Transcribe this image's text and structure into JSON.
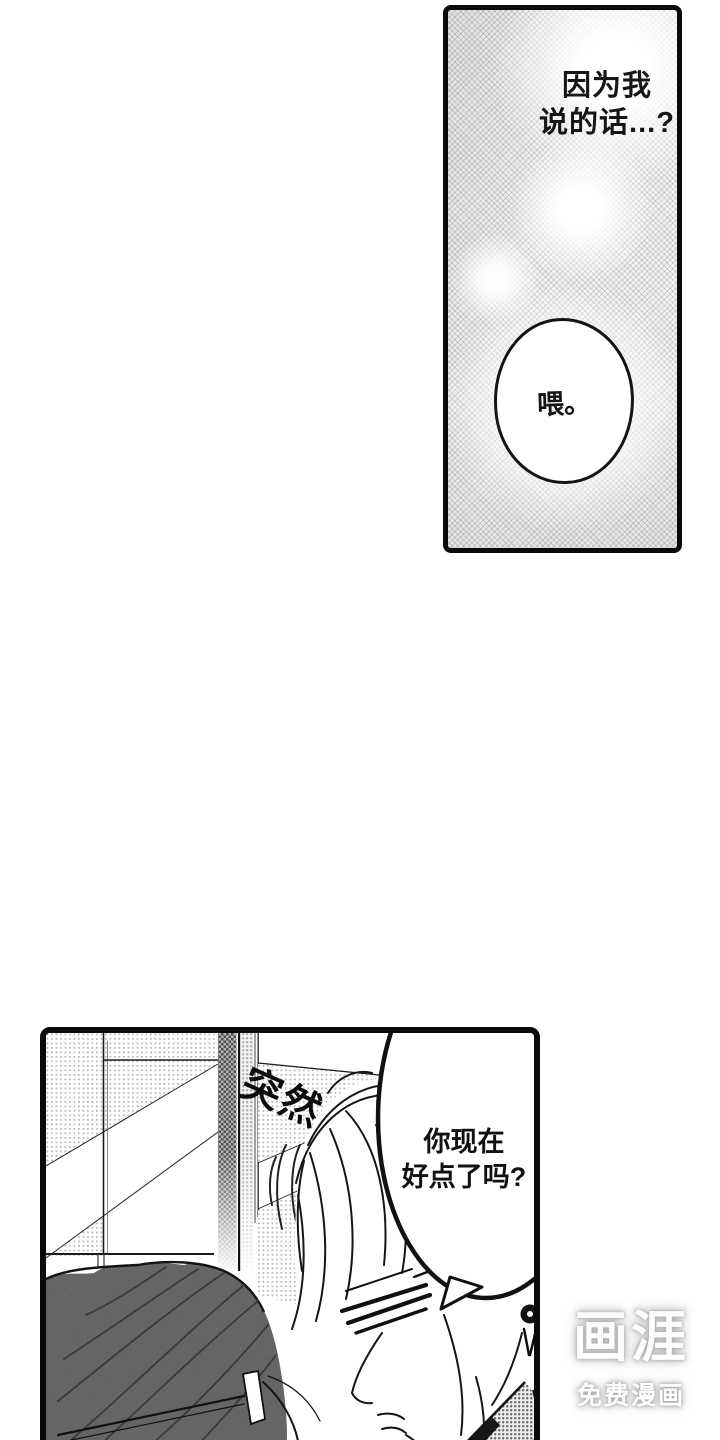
{
  "page": {
    "background": "#ffffff",
    "width": 720,
    "height": 1440
  },
  "panel_top": {
    "caption_line1": "因为我",
    "caption_line2": "说的话...?",
    "bubble_text": "喂。"
  },
  "panel_bottom": {
    "sfx_text": "突然",
    "bubble_line1": "你现在",
    "bubble_line2": "好点了吗?"
  },
  "watermark": {
    "logo_text": "画涯",
    "tagline_text": "免费漫画"
  },
  "colors": {
    "ink": "#111111",
    "panel_border": "#0a0a0a",
    "halftone_gray": "#c6c6c6",
    "watermark_glow": "#a6a6a6"
  }
}
